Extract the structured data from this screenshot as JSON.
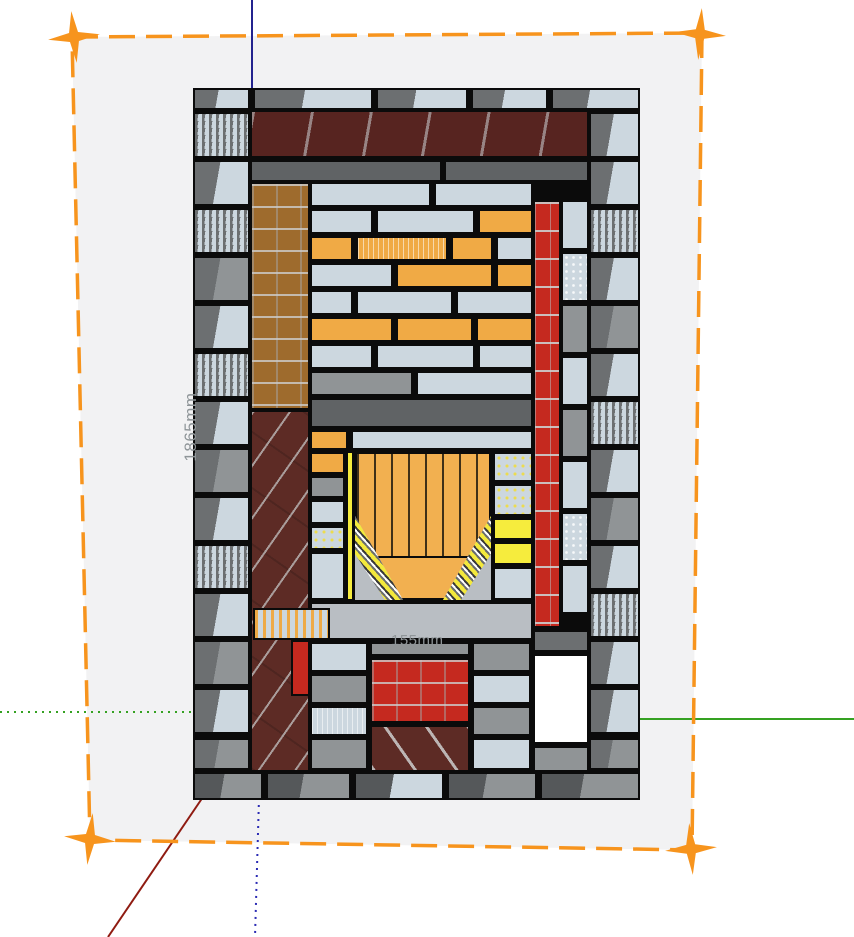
{
  "app": {
    "name": "3d-model-viewport",
    "description": "Cut-away section of a brick masonry heater on a selected section plane"
  },
  "labels": {
    "height_dimension": "1865mm",
    "depth_dimension": "155mm"
  },
  "colors": {
    "canvas_bg": "#ffffff",
    "plane_fill": "#f2f2f3",
    "selection_orange": "#f7941d",
    "axis_blue": "#23238e",
    "axis_blue_dotted": "#2b2bb4",
    "axis_green": "#35a122",
    "axis_red": "#8f1b11",
    "outline": "#0b0b0b",
    "dim_text": "#8f9598",
    "light": "#ccd7df",
    "grayTop": "#6c6f71",
    "midGray": "#909496",
    "darkSlab": "#606365",
    "slabLight": "#b9bec3",
    "maroon": "#5d2b25",
    "maroonDark": "#572420",
    "red": "#c5291f",
    "orange": "#f0aa45",
    "fireOrange": "#f2b050",
    "brown": "#9e6b2d",
    "yellow": "#f6ec3d",
    "white": "#ffffff",
    "baseGray": "#55585a"
  },
  "structure": {
    "x": 193,
    "y": 88,
    "w": 447,
    "h": 712,
    "bricks": [
      {
        "x": 0,
        "y": 0,
        "w": 57,
        "h": 22,
        "c": "light",
        "g": "grayTop"
      },
      {
        "x": 60,
        "y": 0,
        "w": 120,
        "h": 22,
        "c": "light",
        "g": "grayTop",
        "t": "v"
      },
      {
        "x": 183,
        "y": 0,
        "w": 92,
        "h": 22,
        "c": "light",
        "g": "grayTop"
      },
      {
        "x": 278,
        "y": 0,
        "w": 77,
        "h": 22,
        "c": "light",
        "g": "grayTop"
      },
      {
        "x": 358,
        "y": 0,
        "w": 89,
        "h": 22,
        "c": "light",
        "g": "grayTop"
      },
      {
        "x": 0,
        "y": 24,
        "w": 57,
        "h": 46,
        "c": "light",
        "g": "grayTop",
        "t": "s"
      },
      {
        "x": 57,
        "y": 22,
        "w": 339,
        "h": 48,
        "c": "maroonDark",
        "t": "joist"
      },
      {
        "x": 396,
        "y": 24,
        "w": 51,
        "h": 46,
        "c": "light",
        "g": "grayTop"
      },
      {
        "x": 57,
        "y": 72,
        "w": 192,
        "h": 22,
        "c": "darkSlab"
      },
      {
        "x": 251,
        "y": 72,
        "w": 145,
        "h": 22,
        "c": "darkSlab"
      },
      {
        "x": 0,
        "y": 72,
        "w": 57,
        "h": 46,
        "c": "light",
        "g": "grayTop"
      },
      {
        "x": 0,
        "y": 120,
        "w": 57,
        "h": 46,
        "c": "light",
        "g": "grayTop",
        "t": "s"
      },
      {
        "x": 0,
        "y": 168,
        "w": 57,
        "h": 46,
        "c": "midGray",
        "g": "grayTop"
      },
      {
        "x": 0,
        "y": 216,
        "w": 57,
        "h": 46,
        "c": "light",
        "g": "grayTop"
      },
      {
        "x": 0,
        "y": 264,
        "w": 57,
        "h": 46,
        "c": "light",
        "g": "grayTop",
        "t": "s"
      },
      {
        "x": 0,
        "y": 312,
        "w": 57,
        "h": 46,
        "c": "light",
        "g": "grayTop"
      },
      {
        "x": 0,
        "y": 360,
        "w": 57,
        "h": 46,
        "c": "midGray",
        "g": "grayTop"
      },
      {
        "x": 0,
        "y": 408,
        "w": 57,
        "h": 46,
        "c": "light",
        "g": "grayTop"
      },
      {
        "x": 0,
        "y": 456,
        "w": 57,
        "h": 46,
        "c": "light",
        "g": "grayTop",
        "t": "s"
      },
      {
        "x": 0,
        "y": 504,
        "w": 57,
        "h": 46,
        "c": "light",
        "g": "grayTop"
      },
      {
        "x": 0,
        "y": 552,
        "w": 57,
        "h": 46,
        "c": "midGray",
        "g": "grayTop"
      },
      {
        "x": 0,
        "y": 600,
        "w": 57,
        "h": 46,
        "c": "light",
        "g": "grayTop"
      },
      {
        "x": 0,
        "y": 650,
        "w": 57,
        "h": 32,
        "c": "midGray",
        "g": "grayTop"
      },
      {
        "x": 396,
        "y": 72,
        "w": 51,
        "h": 46,
        "c": "light",
        "g": "grayTop"
      },
      {
        "x": 396,
        "y": 120,
        "w": 51,
        "h": 46,
        "c": "light",
        "g": "grayTop",
        "t": "s"
      },
      {
        "x": 396,
        "y": 168,
        "w": 51,
        "h": 46,
        "c": "light",
        "g": "grayTop"
      },
      {
        "x": 396,
        "y": 216,
        "w": 51,
        "h": 46,
        "c": "midGray",
        "g": "grayTop"
      },
      {
        "x": 396,
        "y": 264,
        "w": 51,
        "h": 46,
        "c": "light",
        "g": "grayTop"
      },
      {
        "x": 396,
        "y": 312,
        "w": 51,
        "h": 46,
        "c": "light",
        "g": "grayTop",
        "t": "s"
      },
      {
        "x": 396,
        "y": 360,
        "w": 51,
        "h": 46,
        "c": "light",
        "g": "grayTop"
      },
      {
        "x": 396,
        "y": 408,
        "w": 51,
        "h": 46,
        "c": "midGray",
        "g": "grayTop"
      },
      {
        "x": 396,
        "y": 456,
        "w": 51,
        "h": 46,
        "c": "light",
        "g": "grayTop"
      },
      {
        "x": 396,
        "y": 504,
        "w": 51,
        "h": 46,
        "c": "light",
        "g": "grayTop",
        "t": "s"
      },
      {
        "x": 396,
        "y": 552,
        "w": 51,
        "h": 46,
        "c": "light",
        "g": "grayTop"
      },
      {
        "x": 396,
        "y": 600,
        "w": 51,
        "h": 46,
        "c": "light",
        "g": "grayTop"
      },
      {
        "x": 396,
        "y": 650,
        "w": 51,
        "h": 32,
        "c": "midGray",
        "g": "grayTop"
      },
      {
        "x": 57,
        "y": 94,
        "w": 60,
        "h": 228,
        "c": "brown",
        "t": "bgrid"
      },
      {
        "x": 57,
        "y": 322,
        "w": 60,
        "h": 362,
        "c": "maroon",
        "t": "diag"
      },
      {
        "x": 98,
        "y": 552,
        "w": 19,
        "h": 56,
        "c": "red"
      },
      {
        "x": 368,
        "y": 112,
        "w": 28,
        "h": 50,
        "c": "light"
      },
      {
        "x": 368,
        "y": 164,
        "w": 28,
        "h": 50,
        "c": "light",
        "t": "s"
      },
      {
        "x": 368,
        "y": 216,
        "w": 28,
        "h": 50,
        "c": "midGray"
      },
      {
        "x": 368,
        "y": 268,
        "w": 28,
        "h": 50,
        "c": "light"
      },
      {
        "x": 368,
        "y": 320,
        "w": 28,
        "h": 50,
        "c": "midGray"
      },
      {
        "x": 368,
        "y": 372,
        "w": 28,
        "h": 50,
        "c": "light"
      },
      {
        "x": 368,
        "y": 424,
        "w": 28,
        "h": 50,
        "c": "light",
        "t": "s"
      },
      {
        "x": 368,
        "y": 476,
        "w": 28,
        "h": 50,
        "c": "light"
      },
      {
        "x": 340,
        "y": 112,
        "w": 28,
        "h": 428,
        "c": "red",
        "t": "brickrow"
      },
      {
        "x": 340,
        "y": 542,
        "w": 56,
        "h": 22,
        "c": "grayTop"
      },
      {
        "x": 340,
        "y": 566,
        "w": 56,
        "h": 90,
        "c": "white"
      },
      {
        "x": 340,
        "y": 658,
        "w": 56,
        "h": 26,
        "c": "midGray"
      },
      {
        "x": 117,
        "y": 94,
        "w": 121,
        "h": 25,
        "c": "light"
      },
      {
        "x": 241,
        "y": 94,
        "w": 99,
        "h": 25,
        "c": "light"
      },
      {
        "x": 117,
        "y": 121,
        "w": 63,
        "h": 25,
        "c": "light"
      },
      {
        "x": 183,
        "y": 121,
        "w": 99,
        "h": 25,
        "c": "light"
      },
      {
        "x": 285,
        "y": 121,
        "w": 55,
        "h": 25,
        "c": "orange"
      },
      {
        "x": 117,
        "y": 148,
        "w": 43,
        "h": 25,
        "c": "orange"
      },
      {
        "x": 163,
        "y": 148,
        "w": 92,
        "h": 25,
        "c": "orange",
        "t": "v"
      },
      {
        "x": 258,
        "y": 148,
        "w": 42,
        "h": 25,
        "c": "orange"
      },
      {
        "x": 303,
        "y": 148,
        "w": 37,
        "h": 25,
        "c": "light"
      },
      {
        "x": 117,
        "y": 175,
        "w": 83,
        "h": 25,
        "c": "light"
      },
      {
        "x": 203,
        "y": 175,
        "w": 97,
        "h": 25,
        "c": "orange"
      },
      {
        "x": 303,
        "y": 175,
        "w": 37,
        "h": 25,
        "c": "orange"
      },
      {
        "x": 117,
        "y": 202,
        "w": 43,
        "h": 25,
        "c": "light"
      },
      {
        "x": 163,
        "y": 202,
        "w": 97,
        "h": 25,
        "c": "light"
      },
      {
        "x": 263,
        "y": 202,
        "w": 77,
        "h": 25,
        "c": "light"
      },
      {
        "x": 117,
        "y": 229,
        "w": 83,
        "h": 25,
        "c": "orange"
      },
      {
        "x": 203,
        "y": 229,
        "w": 77,
        "h": 25,
        "c": "orange"
      },
      {
        "x": 283,
        "y": 229,
        "w": 57,
        "h": 25,
        "c": "orange"
      },
      {
        "x": 117,
        "y": 256,
        "w": 63,
        "h": 25,
        "c": "light"
      },
      {
        "x": 183,
        "y": 256,
        "w": 99,
        "h": 25,
        "c": "light"
      },
      {
        "x": 285,
        "y": 256,
        "w": 55,
        "h": 25,
        "c": "light"
      },
      {
        "x": 117,
        "y": 283,
        "w": 103,
        "h": 25,
        "c": "midGray"
      },
      {
        "x": 223,
        "y": 283,
        "w": 117,
        "h": 25,
        "c": "light"
      },
      {
        "x": 117,
        "y": 310,
        "w": 223,
        "h": 30,
        "c": "darkSlab"
      },
      {
        "x": 117,
        "y": 342,
        "w": 38,
        "h": 20,
        "c": "orange"
      },
      {
        "x": 158,
        "y": 342,
        "w": 182,
        "h": 20,
        "c": "light"
      },
      {
        "x": 117,
        "y": 364,
        "w": 35,
        "h": 22,
        "c": "orange"
      },
      {
        "x": 117,
        "y": 388,
        "w": 35,
        "h": 22,
        "c": "midGray"
      },
      {
        "x": 117,
        "y": 412,
        "w": 35,
        "h": 24,
        "c": "light"
      },
      {
        "x": 117,
        "y": 438,
        "w": 35,
        "h": 24,
        "c": "light",
        "t": "sY"
      },
      {
        "x": 117,
        "y": 464,
        "w": 35,
        "h": 48,
        "c": "light"
      },
      {
        "x": 154,
        "y": 364,
        "w": 6,
        "h": 148,
        "c": "yellow"
      },
      {
        "x": 162,
        "y": 364,
        "w": 136,
        "h": 148,
        "c": "fireOrange",
        "t": "planks"
      },
      {
        "x": 178,
        "y": 468,
        "w": 104,
        "h": 44,
        "c": "fireOrange"
      },
      {
        "x": 162,
        "y": 428,
        "w": 48,
        "h": 84,
        "c": "slabLight",
        "t": "stripe",
        "clip": "clip-l"
      },
      {
        "x": 250,
        "y": 428,
        "w": 48,
        "h": 84,
        "c": "slabLight",
        "t": "stripe",
        "clip": "clip-r"
      },
      {
        "x": 162,
        "y": 466,
        "w": 30,
        "h": 46,
        "c": "slabLight",
        "clip": "clip-l"
      },
      {
        "x": 268,
        "y": 466,
        "w": 30,
        "h": 46,
        "c": "slabLight",
        "clip": "clip-r"
      },
      {
        "x": 300,
        "y": 364,
        "w": 40,
        "h": 30,
        "c": "light",
        "t": "sY"
      },
      {
        "x": 300,
        "y": 396,
        "w": 40,
        "h": 32,
        "c": "light",
        "t": "sY"
      },
      {
        "x": 300,
        "y": 430,
        "w": 40,
        "h": 22,
        "c": "yellow"
      },
      {
        "x": 300,
        "y": 454,
        "w": 40,
        "h": 23,
        "c": "yellow"
      },
      {
        "x": 300,
        "y": 479,
        "w": 40,
        "h": 33,
        "c": "light"
      },
      {
        "x": 117,
        "y": 514,
        "w": 223,
        "h": 38,
        "c": "slabLight"
      },
      {
        "x": 60,
        "y": 520,
        "w": 77,
        "h": 32,
        "c": "light",
        "t": "fringe"
      },
      {
        "x": 117,
        "y": 554,
        "w": 58,
        "h": 30,
        "c": "light"
      },
      {
        "x": 117,
        "y": 586,
        "w": 58,
        "h": 30,
        "c": "midGray"
      },
      {
        "x": 117,
        "y": 618,
        "w": 58,
        "h": 30,
        "c": "light",
        "t": "v"
      },
      {
        "x": 117,
        "y": 650,
        "w": 58,
        "h": 32,
        "c": "midGray"
      },
      {
        "x": 177,
        "y": 554,
        "w": 100,
        "h": 14,
        "c": "midGray"
      },
      {
        "x": 177,
        "y": 570,
        "w": 100,
        "h": 65,
        "c": "red",
        "t": "bgrid"
      },
      {
        "x": 177,
        "y": 637,
        "w": 100,
        "h": 47,
        "c": "maroon",
        "t": "diagf"
      },
      {
        "x": 279,
        "y": 554,
        "w": 59,
        "h": 30,
        "c": "midGray"
      },
      {
        "x": 279,
        "y": 586,
        "w": 59,
        "h": 30,
        "c": "light"
      },
      {
        "x": 279,
        "y": 618,
        "w": 59,
        "h": 30,
        "c": "midGray"
      },
      {
        "x": 279,
        "y": 650,
        "w": 59,
        "h": 32,
        "c": "light"
      },
      {
        "x": 0,
        "y": 684,
        "w": 70,
        "h": 28,
        "c": "midGray",
        "g": "baseGray"
      },
      {
        "x": 73,
        "y": 684,
        "w": 85,
        "h": 28,
        "c": "midGray",
        "g": "baseGray"
      },
      {
        "x": 161,
        "y": 684,
        "w": 90,
        "h": 28,
        "c": "light",
        "g": "baseGray"
      },
      {
        "x": 254,
        "y": 684,
        "w": 90,
        "h": 28,
        "c": "midGray",
        "g": "baseGray"
      },
      {
        "x": 347,
        "y": 684,
        "w": 100,
        "h": 28,
        "c": "midGray",
        "g": "baseGray"
      }
    ]
  }
}
